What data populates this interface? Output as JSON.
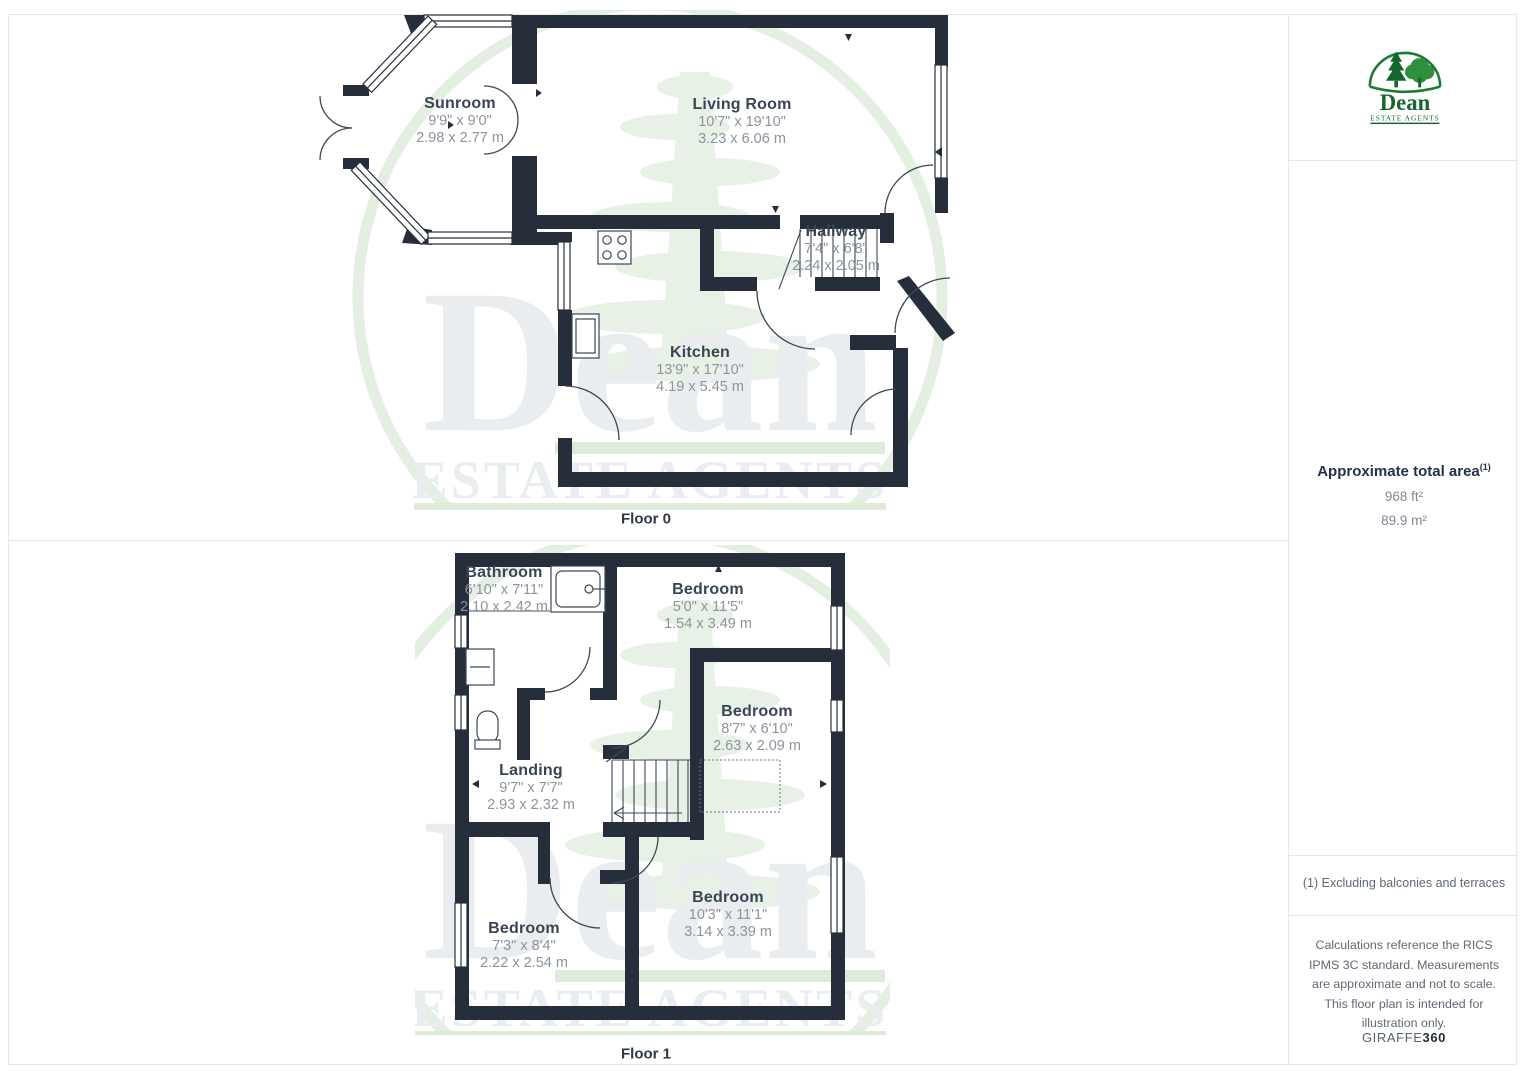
{
  "watermark": {
    "name": "Dean",
    "subtitle": "ESTATE AGENTS"
  },
  "floors": [
    {
      "label": "Floor 0",
      "rooms": [
        {
          "name": "Sunroom",
          "imperial": "9'9\" x 9'0\"",
          "metric": "2.98 x 2.77 m"
        },
        {
          "name": "Living Room",
          "imperial": "10'7\" x 19'10\"",
          "metric": "3.23 x 6.06 m"
        },
        {
          "name": "Hallway",
          "imperial": "7'4\" x 6'8\"",
          "metric": "2.24 x 2.05 m"
        },
        {
          "name": "Kitchen",
          "imperial": "13'9\" x 17'10\"",
          "metric": "4.19 x 5.45 m"
        }
      ]
    },
    {
      "label": "Floor 1",
      "rooms": [
        {
          "name": "Bathroom",
          "imperial": "6'10\" x 7'11\"",
          "metric": "2.10 x 2.42 m"
        },
        {
          "name": "Bedroom",
          "imperial": "5'0\" x 11'5\"",
          "metric": "1.54 x 3.49 m"
        },
        {
          "name": "Bedroom",
          "imperial": "8'7\" x 6'10\"",
          "metric": "2.63 x 2.09 m"
        },
        {
          "name": "Landing",
          "imperial": "9'7\" x 7'7\"",
          "metric": "2.93 x 2.32 m"
        },
        {
          "name": "Bedroom",
          "imperial": "7'3\" x 8'4\"",
          "metric": "2.22 x 2.54 m"
        },
        {
          "name": "Bedroom",
          "imperial": "10'3\" x 11'1\"",
          "metric": "3.14 x 3.39 m"
        }
      ]
    }
  ],
  "sidebar": {
    "logo": {
      "name": "Dean",
      "tagline": "ESTATE AGENTS"
    },
    "area": {
      "title": "Approximate total area",
      "marker": "(1)",
      "imperial": "968 ft²",
      "metric": "89.9 m²"
    },
    "footnote": "(1) Excluding balconies and terraces",
    "disclaimer": "Calculations reference the RICS IPMS 3C standard. Measurements are approximate and not to scale. This floor plan is intended for illustration only.",
    "brand": {
      "name": "GIRAFFE",
      "suffix": "360"
    }
  },
  "colors": {
    "wall": "#272e3b",
    "brand_green": "#15662c",
    "watermark_green": "#e7f1e5",
    "room_name_text": "#394454",
    "dimension_text": "#8b939f"
  }
}
